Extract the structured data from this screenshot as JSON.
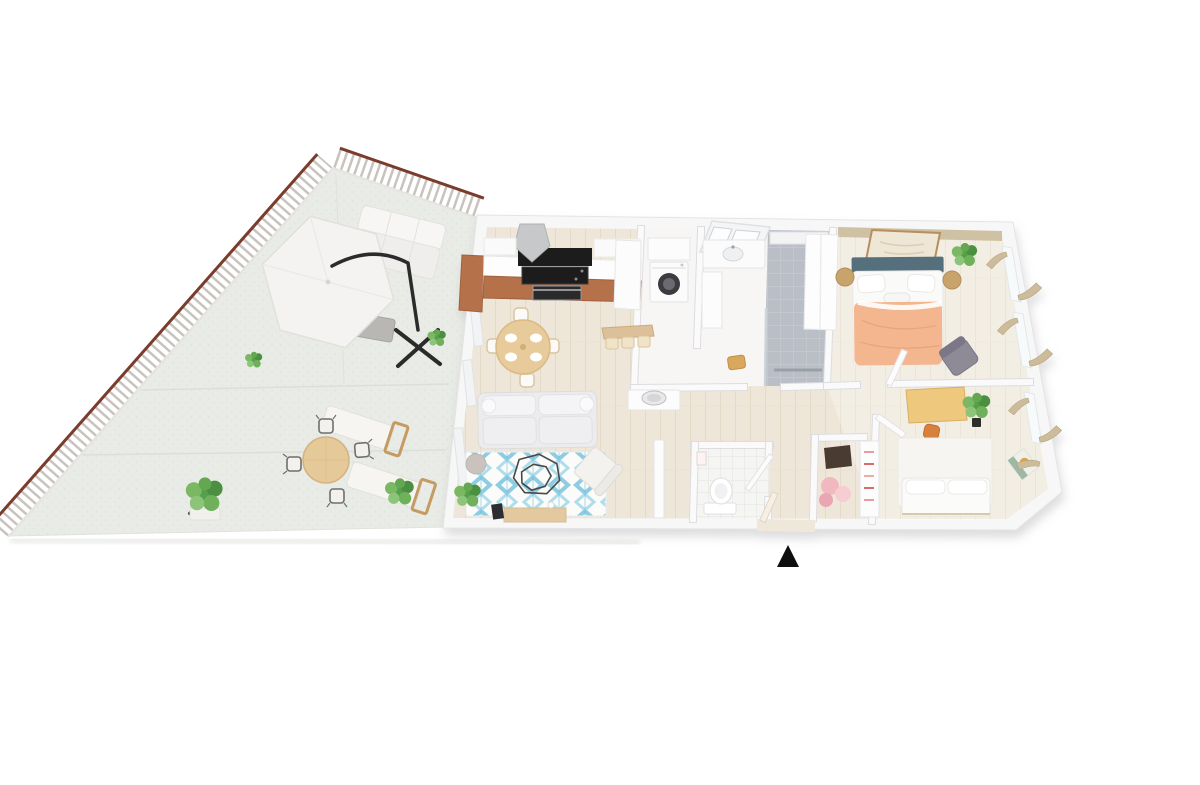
{
  "scene": {
    "type": "3d-floor-plan",
    "description": "Aerial 3D render of a two-bedroom apartment with a large triangular tiled terrace on the left, entrance marked with a black triangle at the bottom",
    "background": "#ffffff"
  },
  "palette": {
    "rail_brown": "#7a3c2c",
    "baluster_gray": "#c8c3be",
    "terrace_floor": "#e9ece6",
    "wood_floor": "#eee7d9",
    "wall_white": "#f7f7f8",
    "bath_tile": "#b9bec7",
    "wc_tile": "#f5f5f3",
    "kitchen_cabinet": "#b5714a",
    "appliance_black": "#1c1c1e",
    "dining_wood": "#e8cb9b",
    "sofa_gray": "#ececee",
    "rug_white": "#fbfbfa",
    "rug_blue": "#7cc5de",
    "pouf_gray": "#cac3bd",
    "tv_console_wood": "#e3c99f",
    "duvet_peach": "#f3b68f",
    "headboard_teal": "#54707c",
    "accent_wall_tan": "#cfc1a3",
    "nightstand_wood": "#c9a36c",
    "armchair_gray": "#8e8a96",
    "desk_yellow": "#eec87c",
    "chair_orange": "#d8803c",
    "curtain_beige": "#cdbc9b",
    "plant_green": "#55a04a",
    "plant_green_light": "#7ab863",
    "art_orange": "#e5a33c",
    "marker_black": "#0e0e0e"
  },
  "terrace": {
    "name": "terrace",
    "shape": "triangular",
    "items": [
      "cantilever-parasol",
      "outdoor-sofa",
      "outdoor-coffee-table",
      "sun-lounger-1",
      "sun-lounger-2",
      "round-dining-table",
      "dining-chairs-x4",
      "plant-small",
      "plant-large",
      "plant-bush",
      "plant-wall"
    ]
  },
  "rooms": [
    {
      "name": "living-kitchen",
      "floor": "light-wood",
      "items": [
        "kitchen-cabinets",
        "cooktop",
        "oven",
        "range-hood",
        "upper-cabinets",
        "tall-unit",
        "dining-table",
        "dining-chairs-x4",
        "sofa",
        "area-rug",
        "coffee-table-wireframe",
        "pouf",
        "armchair",
        "plant",
        "tv-console",
        "leaning-art",
        "entry-bench",
        "baskets-x3",
        "console-table",
        "decor-bowl",
        "decor-vase"
      ]
    },
    {
      "name": "laundry-closet",
      "items": [
        "washing-machine",
        "wall-cabinet"
      ]
    },
    {
      "name": "bathroom",
      "items": [
        "skylight",
        "vanity-sink",
        "tall-cabinet",
        "walk-in-shower",
        "glass-partition",
        "linear-drain",
        "ledge",
        "stool"
      ]
    },
    {
      "name": "wc",
      "items": [
        "toilet",
        "wall-frame",
        "door"
      ]
    },
    {
      "name": "entry-closet",
      "items": [
        "bag",
        "hanging-clothes",
        "shoe-rack"
      ]
    },
    {
      "name": "hallway",
      "items": [
        "doors"
      ]
    },
    {
      "name": "master-bedroom",
      "items": [
        "accent-wall",
        "wall-art",
        "wardrobe",
        "double-bed",
        "headboard",
        "pillows",
        "duvet",
        "nightstand-left",
        "nightstand-right",
        "plant",
        "armchair",
        "window-curtains-x2",
        "door"
      ]
    },
    {
      "name": "bedroom-2",
      "items": [
        "desk",
        "desk-chair",
        "plant",
        "area-rug",
        "daybed-sofa",
        "wall-art-orange-circle",
        "window-curtains-x2",
        "door"
      ]
    }
  ],
  "entrance": {
    "marker": "black-triangle",
    "position": "bottom-center-below-apartment"
  }
}
